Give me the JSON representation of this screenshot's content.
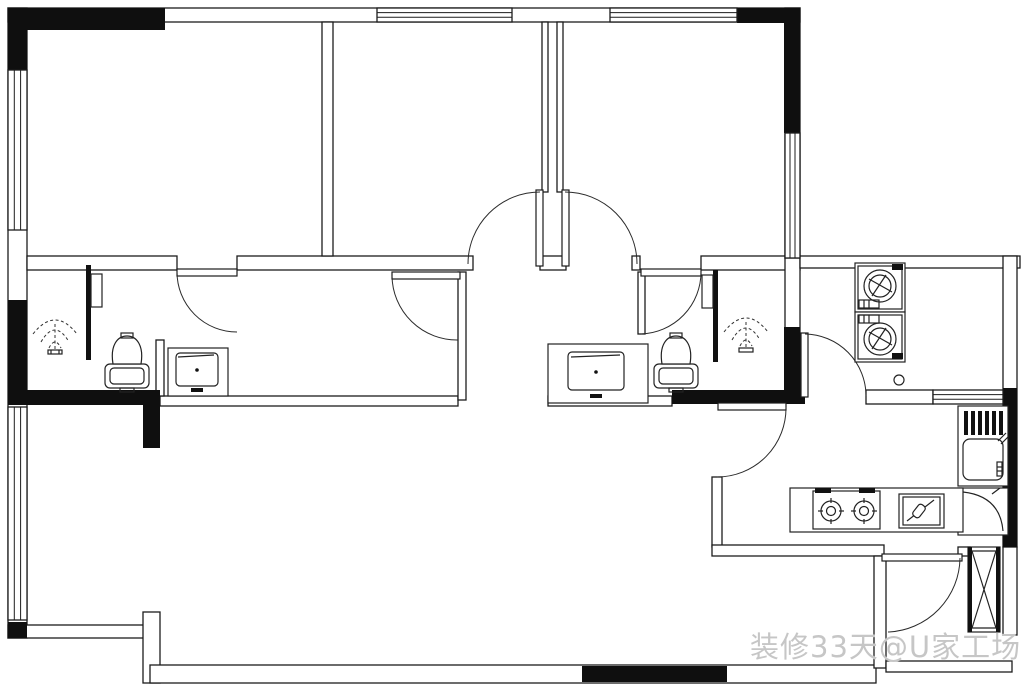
{
  "watermark": {
    "text": "装修33天@U家工场",
    "color": "#c6c6c6"
  },
  "plan": {
    "background": "#ffffff",
    "line_color": "#1c1c1c",
    "structural_wall_color": "#0f0f0f",
    "type": "apartment-floor-plan",
    "doors_visible": 8,
    "window_bands_visible": 6,
    "fixtures": {
      "left_bathroom": [
        "shower-spray-icon",
        "glass-partition-icon",
        "toilet-icon"
      ],
      "left_vestibule": [
        "vanity-sink-icon"
      ],
      "right_bathroom": [
        "shower-spray-icon",
        "glass-partition-icon",
        "toilet-icon"
      ],
      "right_vestibule": [
        "vanity-sink-icon"
      ],
      "laundry_balcony": [
        "washing-machine-icon",
        "washing-machine-icon",
        "floor-drain-icon"
      ],
      "kitchen": [
        "kitchen-sink-icon",
        "corner-cabinet-icon",
        "gas-stove-icon",
        "cutting-board-icon"
      ],
      "entry": [
        "duct-shaft-icon",
        "entry-door-icon"
      ]
    }
  }
}
